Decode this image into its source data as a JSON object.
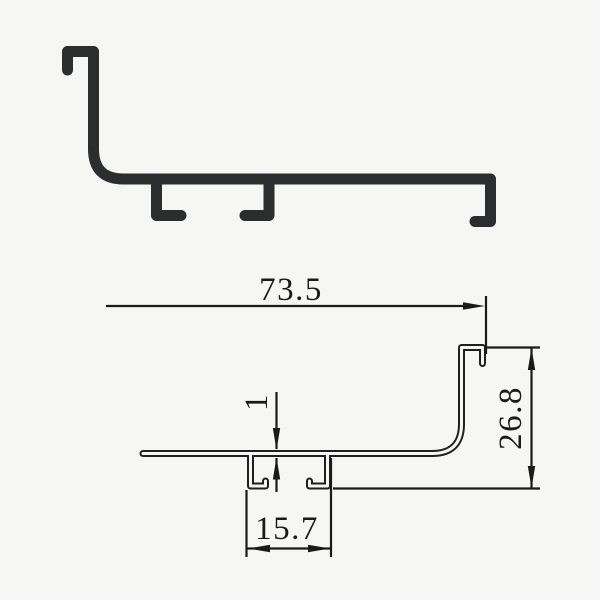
{
  "colors": {
    "background": "#f6f6f4",
    "profile_ink": "#2b2d2e",
    "dimension_ink": "#1a1a1a"
  },
  "dimensions": {
    "overall_width": "73.5",
    "overall_height": "26.8",
    "channel_width": "15.7",
    "wall_thickness": "1"
  }
}
